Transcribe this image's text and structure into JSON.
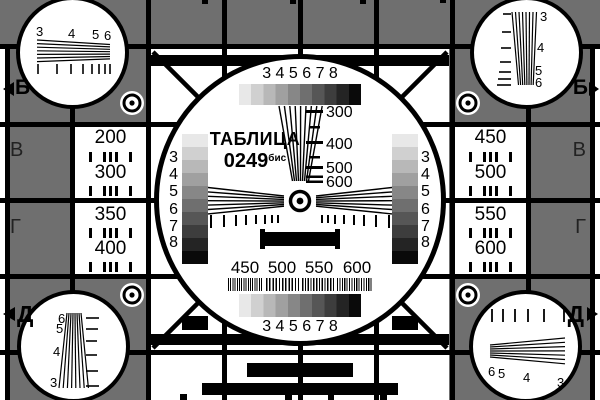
{
  "pattern": {
    "title": "ТАБЛИЦА",
    "code": "0249",
    "code_suffix": "бис",
    "background_gray": "#6f6f6f",
    "grayscale_steps": [
      "#e8e8e8",
      "#d0d0d0",
      "#b8b8b8",
      "#a0a0a0",
      "#878787",
      "#6f6f6f",
      "#565656",
      "#3d3d3d",
      "#242424",
      "#0a0a0a"
    ]
  },
  "row_markers": {
    "left": {
      "b": "Б",
      "v": "В",
      "g": "Г",
      "d": "Д"
    },
    "right": {
      "b": "Б",
      "v": "В",
      "g": "Г",
      "d": "Д"
    }
  },
  "side_panels": {
    "left": {
      "r1": "200",
      "r2": "300",
      "r3": "350",
      "r4": "400"
    },
    "right": {
      "r1": "450",
      "r2": "500",
      "r3": "550",
      "r4": "600"
    }
  },
  "center_circle": {
    "top_gray_scale_labels": "3 4 5 6 7 8",
    "bottom_gray_scale_labels": "3 4 5 6 7 8",
    "vertical_wedge_labels": {
      "v300": "300",
      "v400": "400",
      "v500": "500",
      "v600": "600"
    },
    "burst_labels": {
      "b450": "450",
      "b500": "500",
      "b550": "550",
      "b600": "600"
    },
    "left_staircase_labels": [
      "3",
      "4",
      "5",
      "6",
      "7",
      "8"
    ],
    "right_staircase_labels": [
      "3",
      "4",
      "5",
      "6",
      "7",
      "8"
    ]
  },
  "corner_circles": {
    "top_left_labels": [
      "3",
      "4",
      "5",
      "6"
    ],
    "top_right_labels": [
      "3",
      "4",
      "5",
      "6"
    ],
    "bottom_left_labels": [
      "6",
      "5",
      "4",
      "3"
    ],
    "bottom_right_labels": [
      "6",
      "5",
      "4",
      "3"
    ]
  }
}
